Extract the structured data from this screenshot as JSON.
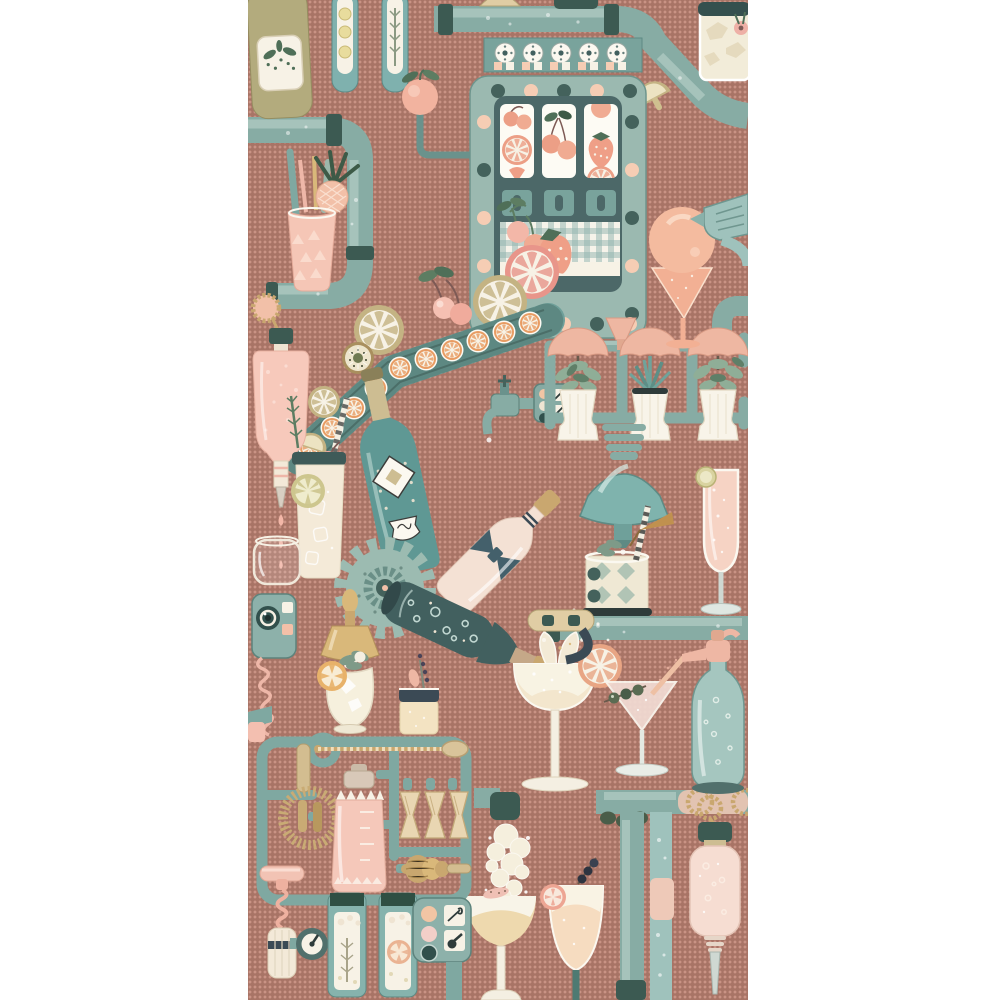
{
  "artwork": {
    "title": "Cocktail factory wallpaper pattern",
    "style": "whimsical illustrated bar-machine contraption on dotted terracotta ground, white margins left and right",
    "panel": {
      "left_px": 248,
      "width_px": 500,
      "height_px": 1000
    }
  },
  "palette": {
    "margin": "#ffffff",
    "panel": "#a87466",
    "dot": "#c99385",
    "pipe": "#87aca4",
    "pipeHi": "#cde0d8",
    "pipeSh": "#5e8178",
    "collar": "#3c5a52",
    "slot": "#9bb9b0",
    "slotBar": "#79a39c",
    "slotIn": "#4c6868",
    "paper": "#f7f2e6",
    "cream": "#ecdfc8",
    "peach": "#f4c4a8",
    "blush": "#f3bfb0",
    "pinkpale": "#f7d8cc",
    "salmon": "#ec9f86",
    "khaki": "#d6c795",
    "khakiD": "#b3a274",
    "gold": "#c9a76f",
    "tealB": "#5f9894",
    "darkB": "#42605f",
    "leaf": "#4f6f58",
    "sage": "#8fae97",
    "oliveB": "#b3ab7d",
    "slate": "#3b4a55",
    "ice": "#dfe7e2"
  },
  "objects": [
    {
      "id": "olive-syrup-bottle",
      "label": "khaki bottle with botanical label, top left"
    },
    {
      "id": "infusion-tube-lemon",
      "label": "hanging tube with lemon slices"
    },
    {
      "id": "infusion-tube-rosemary",
      "label": "hanging tube with rosemary"
    },
    {
      "id": "top-pipe",
      "label": "horizontal bubbling pipe across the top"
    },
    {
      "id": "iced-glass-top-right",
      "label": "rocks glass with ice and pink blossom"
    },
    {
      "id": "lemon-wedge-pipe",
      "label": "lemon wedge on pipe elbow"
    },
    {
      "id": "slot-machine",
      "label": "teal fruit slot machine with light bulbs"
    },
    {
      "id": "slot-reels",
      "label": "three reels with cherries, oranges, strawberries"
    },
    {
      "id": "fruit-tray",
      "label": "gingham tray with cherries and strawberry"
    },
    {
      "id": "peach-on-arm",
      "label": "peach on a mechanical arm"
    },
    {
      "id": "conveyor-belt",
      "label": "diagonal conveyor of orange slices"
    },
    {
      "id": "kiwi-slice",
      "label": "kiwi slice on belt"
    },
    {
      "id": "lemon-slices",
      "label": "lemon and grapefruit wheels"
    },
    {
      "id": "faucet",
      "label": "small teal tap with button panel"
    },
    {
      "id": "plant-shelf",
      "label": "pipe shelf with three potted herbs under peach shades"
    },
    {
      "id": "peach-funnel",
      "label": "small peach funnel above shelf"
    },
    {
      "id": "juicer-funnel",
      "label": "teal ribbed press dripping into glass"
    },
    {
      "id": "argyle-glass",
      "label": "argyle rocks glass with straw and umbrella"
    },
    {
      "id": "champagne-flute",
      "label": "flute with fizz and lime garnish"
    },
    {
      "id": "teal-champagne-bottle",
      "label": "teal bottle with diamond label"
    },
    {
      "id": "blush-champagne-bottle",
      "label": "blush bottle with bow label"
    },
    {
      "id": "gear",
      "label": "large sage cog wheel"
    },
    {
      "id": "pouring-bottle",
      "label": "dark bottle pouring sparkling foam"
    },
    {
      "id": "margarita-coupe",
      "label": "coupe being filled, orange-wheel garnish"
    },
    {
      "id": "martini-glass",
      "label": "martini with olive pick and soda spray"
    },
    {
      "id": "soda-siphon",
      "label": "teal soda siphon with peach nozzle"
    },
    {
      "id": "rope-rings",
      "label": "rope rings on lower pipe"
    },
    {
      "id": "olive-cluster",
      "label": "olives under pipe"
    },
    {
      "id": "dropper-bottle",
      "label": "inverted blush dropper bottle on rope"
    },
    {
      "id": "foam-spout",
      "label": "spout puffing foam cloud"
    },
    {
      "id": "foam-coupe",
      "label": "coupe with foam cap and citrus chip"
    },
    {
      "id": "nick-nora-glass",
      "label": "sour glass with grapefruit wheel and berry pick"
    },
    {
      "id": "tool-sprue-frame",
      "label": "model-kit frame of bar tools"
    },
    {
      "id": "bar-spoon",
      "label": "twisted gold bar spoon"
    },
    {
      "id": "spring-strainer",
      "label": "coiled hawthorne strainer"
    },
    {
      "id": "cocktail-shaker",
      "label": "pink cocktail shaker"
    },
    {
      "id": "jiggers",
      "label": "three wooden jiggers"
    },
    {
      "id": "honey-dipper",
      "label": "ribbed muddler"
    },
    {
      "id": "corkscrew",
      "label": "pink and cream corkscrew"
    },
    {
      "id": "gauge",
      "label": "round dial gauge"
    },
    {
      "id": "bottom-tubes",
      "label": "two botanical infusion tubes"
    },
    {
      "id": "button-panel",
      "label": "control panel with round buttons"
    },
    {
      "id": "intercom",
      "label": "camera intercom with coiled pink cord"
    },
    {
      "id": "gold-funnel-lamp",
      "label": "gold funnel dripping into julep glass"
    },
    {
      "id": "sour-rocks-glass",
      "label": "dark-rim glass with lavender sprig"
    },
    {
      "id": "collins-glass",
      "label": "collins glass with lime wheel and straw"
    },
    {
      "id": "stemless-glass",
      "label": "empty stemless glass"
    },
    {
      "id": "bitters-bottle",
      "label": "inverted pink bitters bottle dripping"
    },
    {
      "id": "tiki-drink",
      "label": "pink tumbler with pineapple garnish"
    },
    {
      "id": "sorbet-coupe",
      "label": "peach sphere in peach martini glass"
    },
    {
      "id": "mixer-gun",
      "label": "teal blender gun at right edge"
    }
  ]
}
